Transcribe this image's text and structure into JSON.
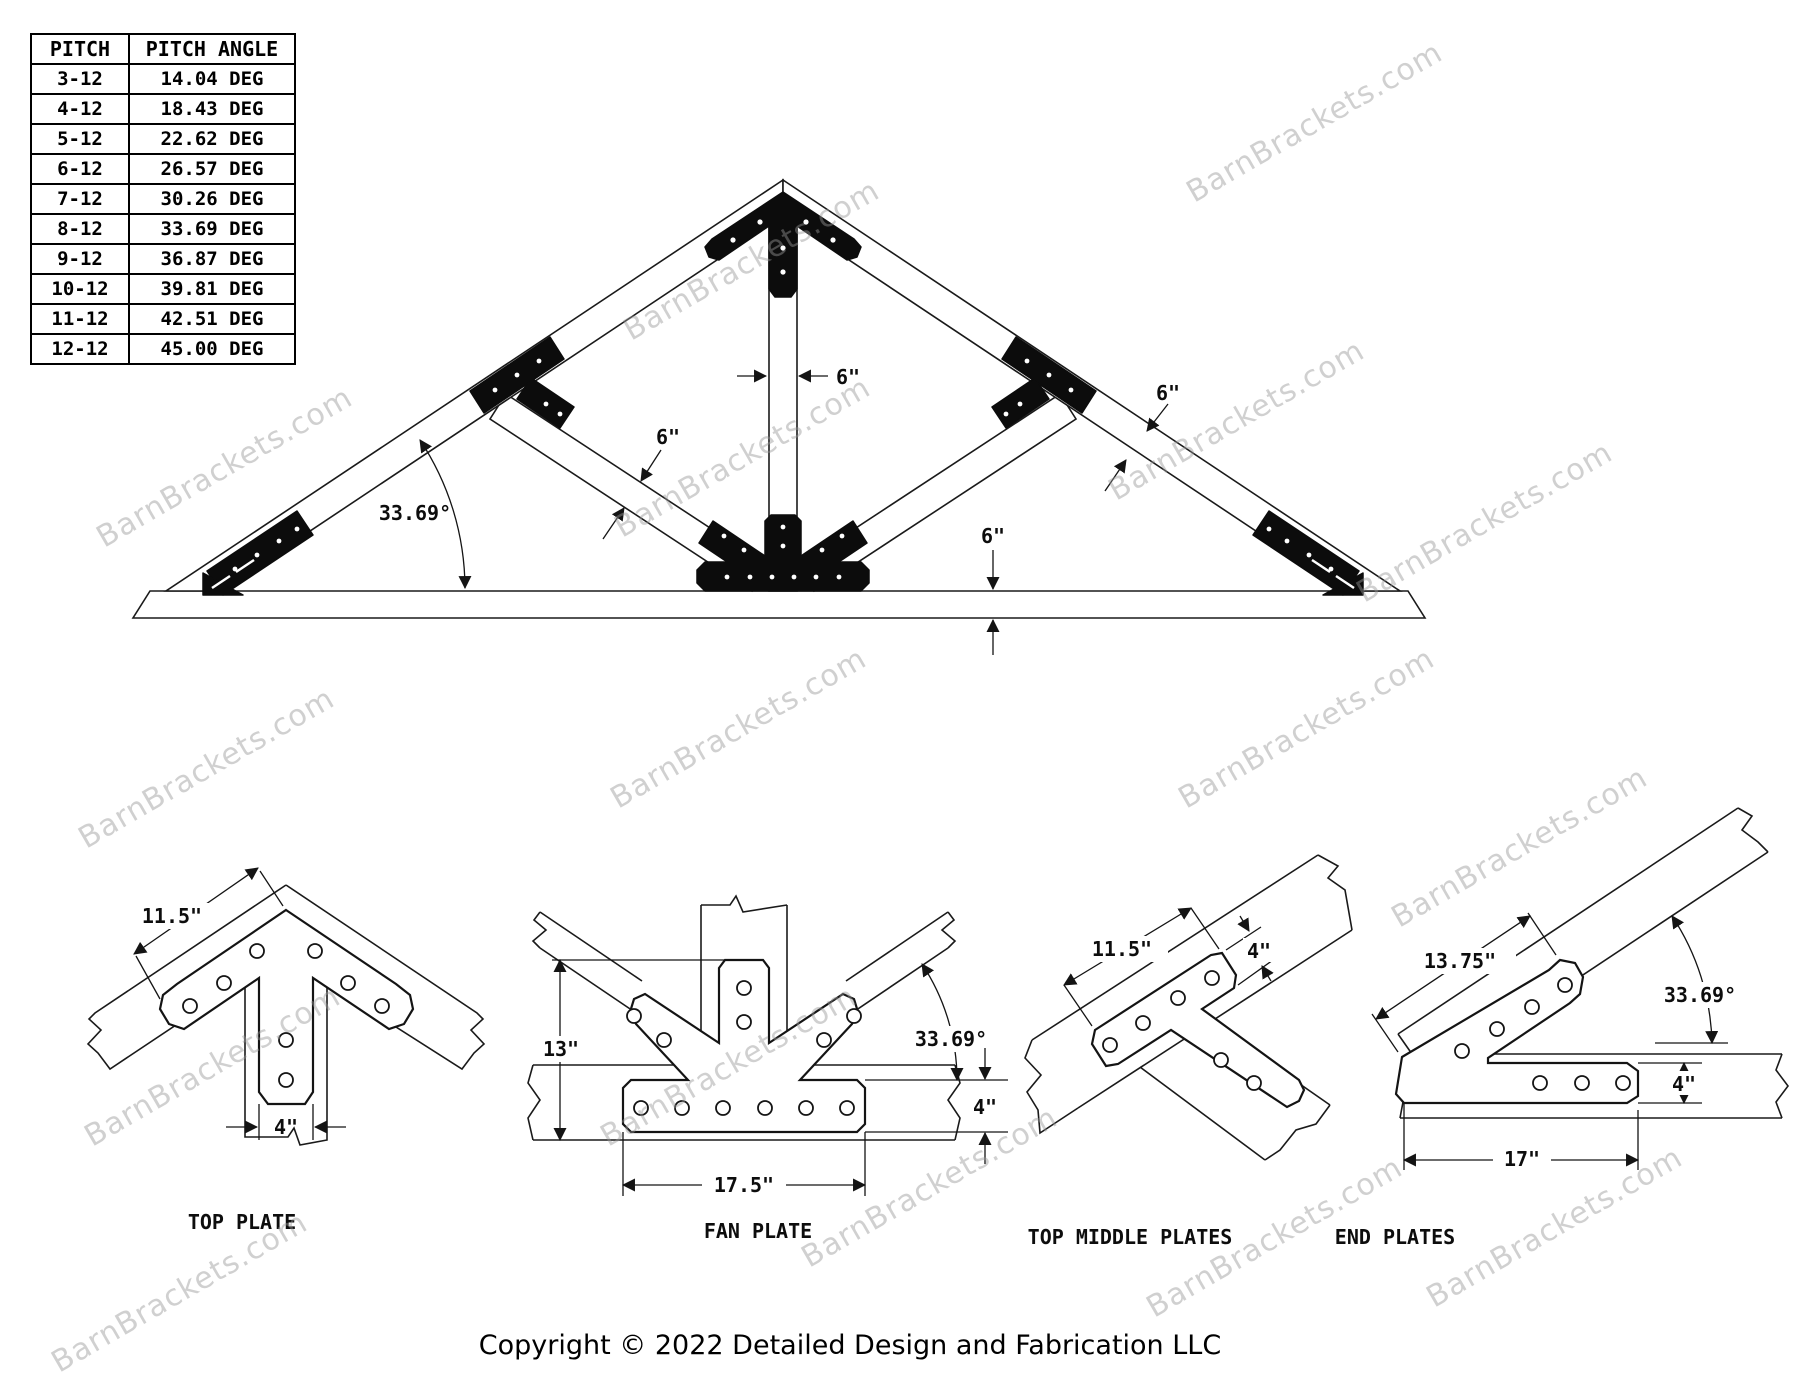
{
  "watermark": {
    "text": "BarnBrackets.com"
  },
  "pitch_table": {
    "headers": [
      "PITCH",
      "PITCH ANGLE"
    ],
    "rows": [
      {
        "pitch": "3-12",
        "angle": "14.04 DEG"
      },
      {
        "pitch": "4-12",
        "angle": "18.43 DEG"
      },
      {
        "pitch": "5-12",
        "angle": "22.62 DEG"
      },
      {
        "pitch": "6-12",
        "angle": "26.57 DEG"
      },
      {
        "pitch": "7-12",
        "angle": "30.26 DEG"
      },
      {
        "pitch": "8-12",
        "angle": "33.69 DEG"
      },
      {
        "pitch": "9-12",
        "angle": "36.87 DEG"
      },
      {
        "pitch": "10-12",
        "angle": "39.81 DEG"
      },
      {
        "pitch": "11-12",
        "angle": "42.51 DEG"
      },
      {
        "pitch": "12-12",
        "angle": "45.00 DEG"
      }
    ]
  },
  "truss": {
    "dims": {
      "king_post_width": "6\"",
      "web_width": "6\"",
      "rafter_width": "6\"",
      "chord_height": "6\"",
      "pitch_angle": "33.69°"
    }
  },
  "details": {
    "top_plate": {
      "label": "TOP PLATE",
      "wing_length": "11.5\"",
      "leg_width": "4\""
    },
    "fan_plate": {
      "label": "FAN PLATE",
      "height": "13\"",
      "angle": "33.69°",
      "base_height": "4\"",
      "base_length": "17.5\""
    },
    "top_middle_plates": {
      "label": "TOP MIDDLE PLATES",
      "bar_length": "11.5\"",
      "bar_width": "4\""
    },
    "end_plates": {
      "label": "END PLATES",
      "rafter_length": "13.75\"",
      "angle": "33.69°",
      "foot_height": "4\"",
      "foot_length": "17\""
    }
  },
  "footer": {
    "copyright": "Copyright © 2022 Detailed Design and Fabrication LLC"
  }
}
